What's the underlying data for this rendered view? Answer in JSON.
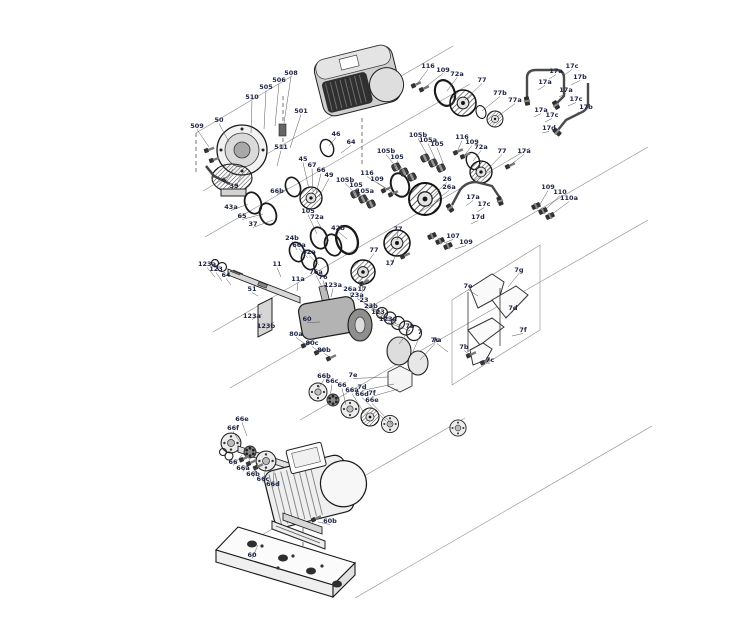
{
  "diagram": {
    "type": "exploded-parts-drawing",
    "background": "#ffffff",
    "line_color": "#2a2a2a",
    "label_color": "#1c2344",
    "leader_color": "#555555",
    "callouts": [
      [
        "509",
        197,
        128,
        209,
        147
      ],
      [
        "50",
        219,
        122,
        229,
        142
      ],
      [
        "510",
        252,
        99,
        251,
        133
      ],
      [
        "505",
        266,
        89,
        264,
        129
      ],
      [
        "506",
        279,
        82,
        275,
        126
      ],
      [
        "508",
        291,
        75,
        284,
        123
      ],
      [
        "501",
        301,
        113,
        290,
        148
      ],
      [
        "511",
        281,
        149,
        277,
        166
      ],
      [
        "6",
        224,
        182,
        233,
        169
      ],
      [
        "39",
        234,
        188,
        243,
        173
      ],
      [
        "43a",
        231,
        209,
        248,
        204
      ],
      [
        "65",
        242,
        218,
        263,
        214
      ],
      [
        "37",
        253,
        226,
        273,
        220
      ],
      [
        "46",
        336,
        136,
        329,
        146
      ],
      [
        "64",
        351,
        144,
        341,
        153
      ],
      [
        "45",
        303,
        161,
        309,
        189
      ],
      [
        "67",
        312,
        167,
        313,
        191
      ],
      [
        "66",
        321,
        172,
        316,
        194
      ],
      [
        "49",
        329,
        177,
        319,
        197
      ],
      [
        "66b",
        277,
        193,
        288,
        188
      ],
      [
        "116",
        428,
        68,
        417,
        84
      ],
      [
        "109",
        443,
        72,
        424,
        88
      ],
      [
        "72a",
        457,
        76,
        447,
        91
      ],
      [
        "77",
        482,
        82,
        465,
        100
      ],
      [
        "77b",
        500,
        95,
        482,
        111
      ],
      [
        "77a",
        515,
        102,
        497,
        117
      ],
      [
        "105b",
        418,
        137,
        429,
        158
      ],
      [
        "105a",
        428,
        142,
        437,
        163
      ],
      [
        "105",
        437,
        146,
        445,
        168
      ],
      [
        "116",
        462,
        139,
        457,
        152
      ],
      [
        "109",
        472,
        144,
        464,
        156
      ],
      [
        "72a",
        481,
        149,
        473,
        161
      ],
      [
        "77",
        502,
        153,
        487,
        170
      ],
      [
        "17a",
        524,
        153,
        509,
        166
      ],
      [
        "105b",
        386,
        153,
        396,
        167
      ],
      [
        "105",
        397,
        159,
        404,
        172
      ],
      [
        "116",
        367,
        175,
        385,
        188
      ],
      [
        "109",
        377,
        181,
        392,
        192
      ],
      [
        "105b",
        345,
        182,
        355,
        193
      ],
      [
        "105",
        356,
        187,
        362,
        197
      ],
      [
        "105a",
        365,
        193,
        370,
        202
      ],
      [
        "105",
        308,
        213,
        317,
        234
      ],
      [
        "72a",
        317,
        219,
        329,
        241
      ],
      [
        "42b",
        338,
        230,
        347,
        239
      ],
      [
        "24b",
        292,
        240,
        297,
        250
      ],
      [
        "66a",
        299,
        247,
        308,
        258
      ],
      [
        "42a",
        309,
        254,
        319,
        265
      ],
      [
        "26",
        447,
        181,
        432,
        196
      ],
      [
        "26a",
        449,
        189,
        434,
        202
      ],
      [
        "77",
        398,
        231,
        397,
        240
      ],
      [
        "17",
        390,
        265,
        396,
        255
      ],
      [
        "77",
        374,
        252,
        367,
        263
      ],
      [
        "17",
        362,
        291,
        363,
        284
      ],
      [
        "17c",
        572,
        68,
        563,
        76
      ],
      [
        "17a",
        556,
        73,
        549,
        79
      ],
      [
        "17b",
        580,
        79,
        571,
        85
      ],
      [
        "17a",
        545,
        84,
        538,
        90
      ],
      [
        "17a",
        566,
        92,
        559,
        97
      ],
      [
        "17c",
        576,
        101,
        568,
        106
      ],
      [
        "17b",
        586,
        109,
        577,
        113
      ],
      [
        "17a",
        541,
        112,
        534,
        117
      ],
      [
        "17c",
        552,
        117,
        545,
        122
      ],
      [
        "17d",
        549,
        130,
        542,
        133
      ],
      [
        "17a",
        473,
        199,
        466,
        206
      ],
      [
        "17c",
        484,
        206,
        477,
        212
      ],
      [
        "17d",
        478,
        219,
        471,
        224
      ],
      [
        "107",
        453,
        238,
        444,
        243
      ],
      [
        "109",
        466,
        244,
        455,
        249
      ],
      [
        "109",
        548,
        189,
        539,
        206
      ],
      [
        "110",
        560,
        194,
        545,
        210
      ],
      [
        "110a",
        569,
        200,
        551,
        215
      ],
      [
        "123a",
        207,
        266,
        215,
        277
      ],
      [
        "123",
        216,
        271,
        222,
        281
      ],
      [
        "64",
        226,
        277,
        231,
        285
      ],
      [
        "51",
        252,
        291,
        258,
        296
      ],
      [
        "11",
        277,
        266,
        281,
        277
      ],
      [
        "11a",
        298,
        281,
        297,
        291
      ],
      [
        "76a",
        316,
        274,
        322,
        287
      ],
      [
        "76",
        323,
        279,
        326,
        291
      ],
      [
        "123a",
        333,
        287,
        331,
        297
      ],
      [
        "26a",
        350,
        291,
        352,
        300
      ],
      [
        "23a",
        357,
        297,
        382,
        313
      ],
      [
        "23",
        364,
        302,
        389,
        318
      ],
      [
        "23b",
        371,
        308,
        396,
        323
      ],
      [
        "123",
        378,
        314,
        403,
        327
      ],
      [
        "123a",
        388,
        321,
        410,
        331
      ],
      [
        "7b",
        410,
        328,
        399,
        344
      ],
      [
        "7",
        420,
        334,
        412,
        354
      ],
      [
        "7c",
        435,
        342,
        420,
        360
      ],
      [
        "60",
        307,
        321,
        320,
        322
      ],
      [
        "123a",
        252,
        318,
        262,
        314
      ],
      [
        "123b",
        266,
        328,
        274,
        322
      ],
      [
        "80a",
        296,
        336,
        305,
        344
      ],
      [
        "80c",
        312,
        345,
        318,
        351
      ],
      [
        "80b",
        324,
        352,
        330,
        357
      ],
      [
        "7g",
        519,
        272,
        508,
        287
      ],
      [
        "7e",
        468,
        288,
        478,
        296
      ],
      [
        "7d",
        513,
        310,
        505,
        318
      ],
      [
        "7f",
        523,
        332,
        512,
        336
      ],
      [
        "7a",
        437,
        342,
        448,
        352
      ],
      [
        "7b",
        464,
        349,
        470,
        355
      ],
      [
        "7c",
        490,
        362,
        483,
        362
      ],
      [
        "7e",
        353,
        377,
        388,
        377
      ],
      [
        "7d",
        362,
        389,
        394,
        384
      ],
      [
        "7f",
        372,
        395,
        398,
        389
      ],
      [
        "66b",
        324,
        378,
        318,
        389
      ],
      [
        "66c",
        332,
        383,
        330,
        397
      ],
      [
        "66",
        342,
        387,
        346,
        405
      ],
      [
        "66a",
        352,
        392,
        364,
        413
      ],
      [
        "66d",
        362,
        396,
        386,
        421
      ],
      [
        "66e",
        372,
        402,
        392,
        424
      ],
      [
        "66e",
        242,
        421,
        247,
        436
      ],
      [
        "66f",
        233,
        430,
        240,
        442
      ],
      [
        "66",
        233,
        464,
        242,
        455
      ],
      [
        "66a",
        243,
        470,
        250,
        459
      ],
      [
        "66b",
        253,
        476,
        258,
        463
      ],
      [
        "66c",
        263,
        481,
        266,
        467
      ],
      [
        "66d",
        273,
        486,
        274,
        471
      ],
      [
        "60b",
        330,
        523,
        318,
        522
      ],
      [
        "60",
        252,
        557,
        258,
        545
      ]
    ]
  }
}
